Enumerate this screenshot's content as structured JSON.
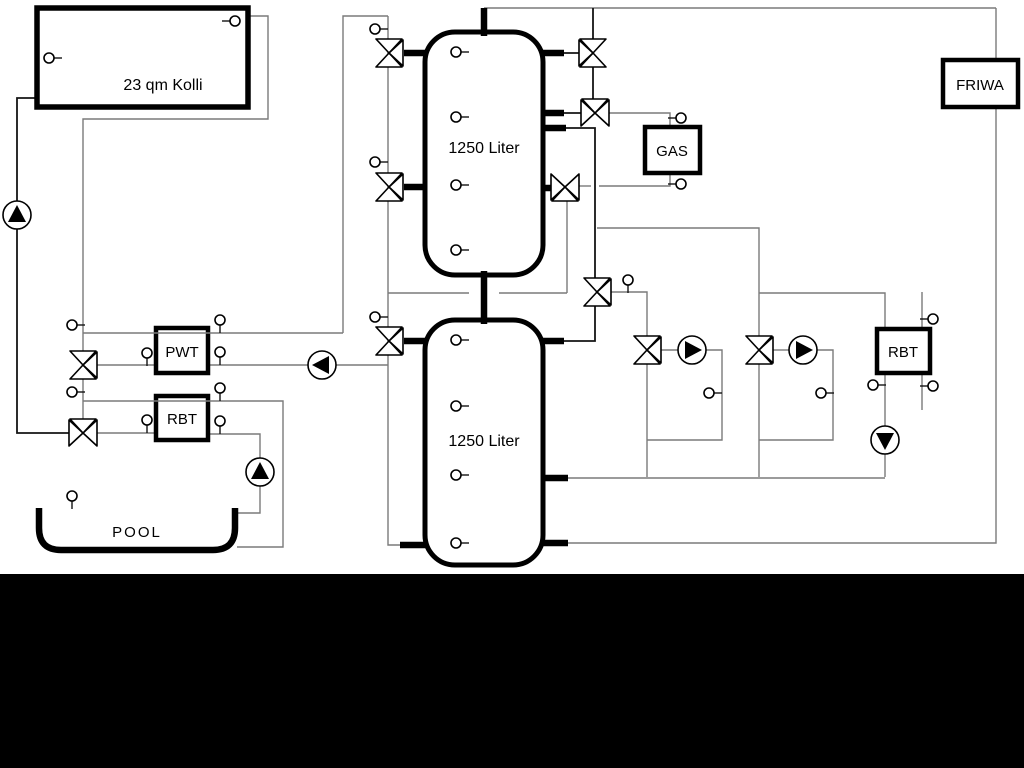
{
  "colors": {
    "background": "#ffffff",
    "bottom_bar": "#000000",
    "line_gray": "#7a7a7a",
    "line_black": "#141414",
    "component_outline": "#000000"
  },
  "labels": {
    "collector": "23 qm Kolli",
    "tank_upper": "1250 Liter",
    "tank_lower": "1250 Liter",
    "pwt": "PWT",
    "rbt_left": "RBT",
    "gas": "GAS",
    "friwa": "FRIWA",
    "rbt_right": "RBT",
    "pool": "POOL"
  },
  "symbols": {
    "pump_icon": "circle with solid triangle (flow direction)",
    "valve_icon": "three-way valve bowtie",
    "sensor_icon": "small circle with stub (temperature sensor)"
  }
}
